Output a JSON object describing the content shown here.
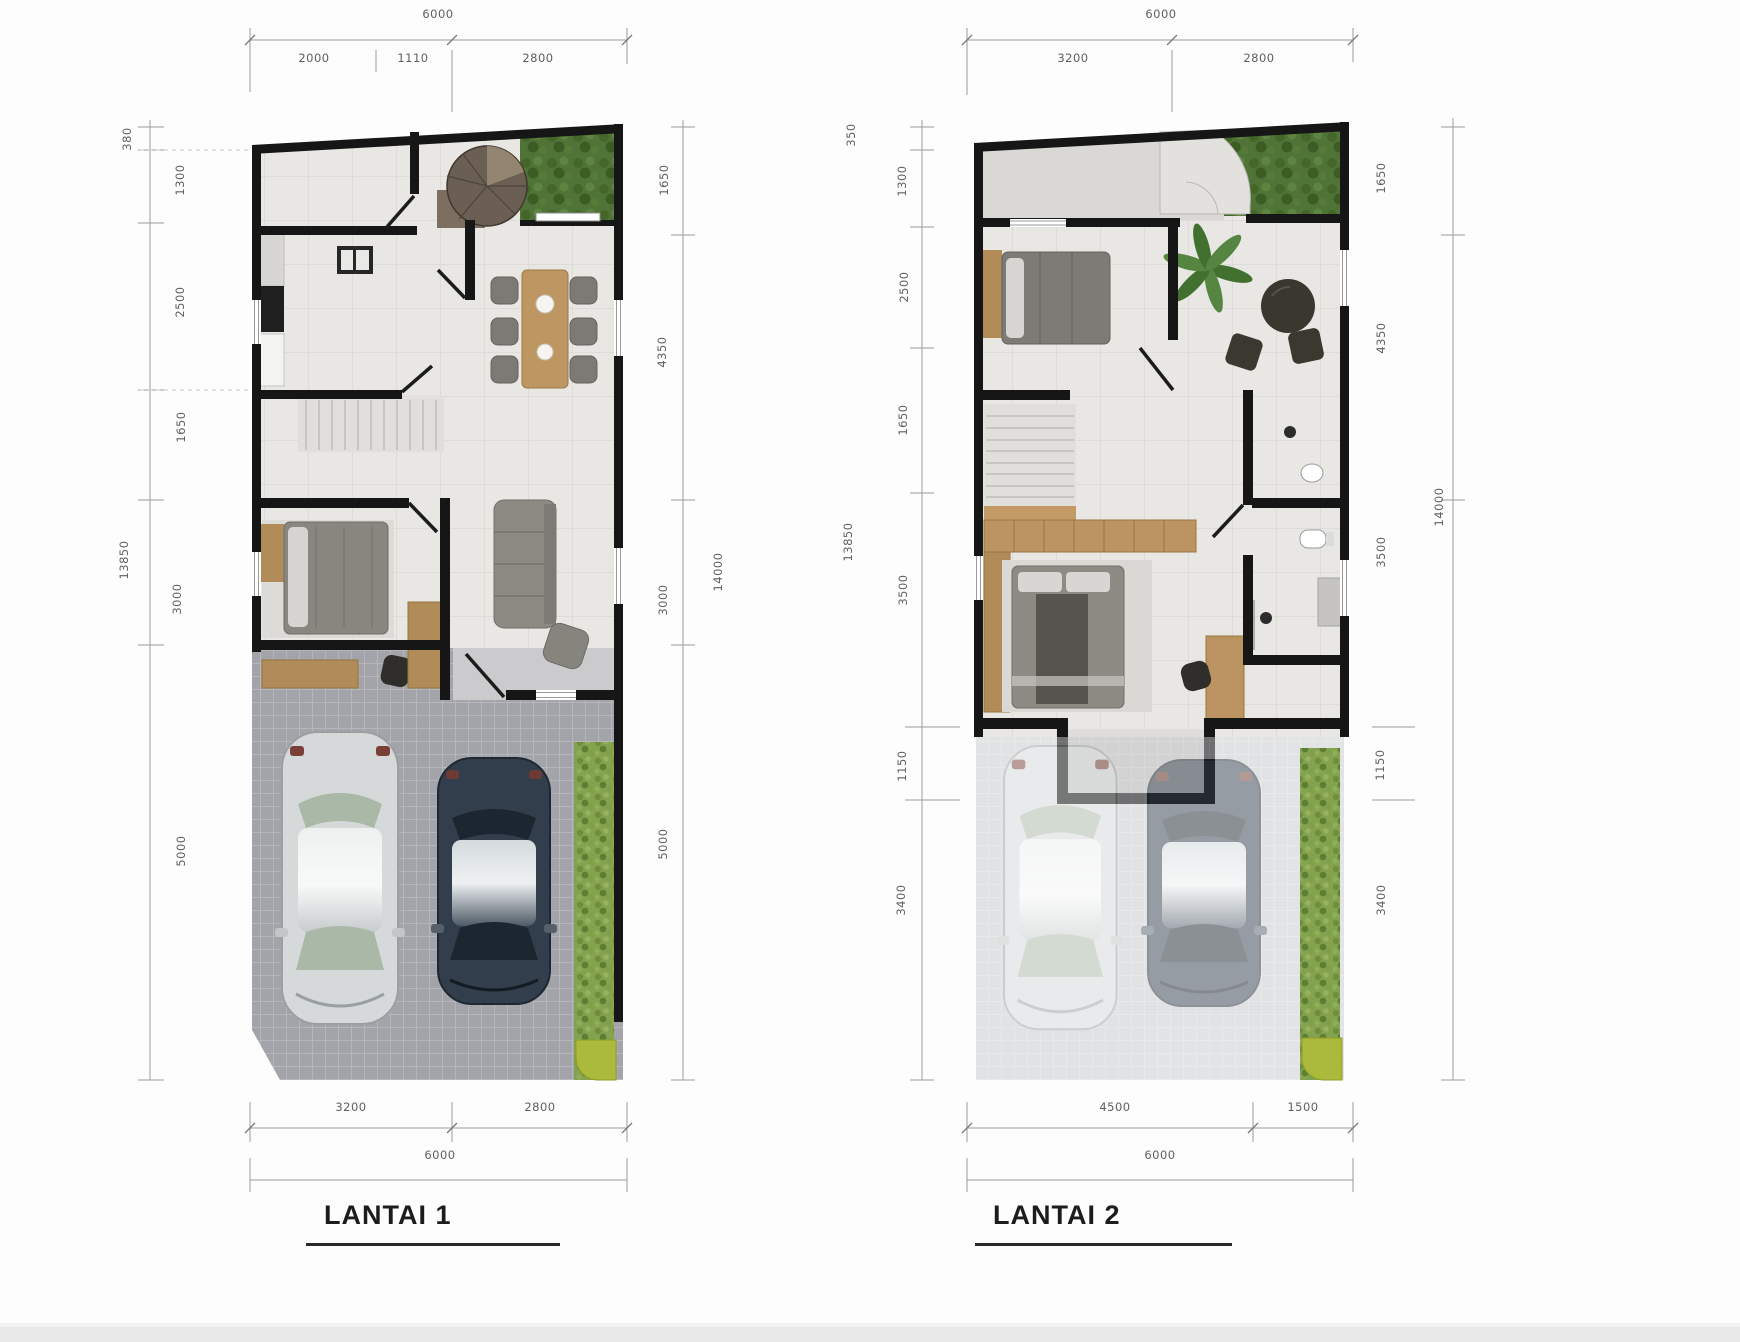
{
  "document": {
    "type": "architectural floor plan, two storeys, scanned drawing"
  },
  "plans": [
    {
      "title": "LANTAI 1",
      "dims": {
        "top_total": "6000",
        "top_segments": [
          "2000",
          "1110",
          "2800"
        ],
        "left_outer": "13850",
        "left_segments": [
          "380",
          "1300",
          "2500",
          "1650",
          "3000",
          "5000"
        ],
        "right_outer": "14000",
        "right_segments": [
          "1650",
          "4350",
          "3000",
          "5000"
        ],
        "bottom_segments": [
          "3200",
          "2800"
        ],
        "bottom_total": "6000"
      }
    },
    {
      "title": "LANTAI 2",
      "dims": {
        "top_total": "6000",
        "top_segments": [
          "3200",
          "2800"
        ],
        "left_outer": "13850",
        "left_segments": [
          "350",
          "1300",
          "2500",
          "1650",
          "3500",
          "1150",
          "3400"
        ],
        "right_outer": "14000",
        "right_segments": [
          "1650",
          "4350",
          "3500",
          "1150",
          "3400"
        ],
        "bottom_segments": [
          "4500",
          "1500"
        ],
        "bottom_total": "6000"
      }
    }
  ],
  "colors": {
    "wall": "#161616",
    "floor": "#e8e7e4",
    "carport_paving": "#a3a4a9",
    "wood": "#bb9461",
    "furniture_grey": "#8b8a83",
    "garden_green": "#507437",
    "hedge_green": "#85a24f",
    "planter_olive": "#abb93c",
    "car_silver": "#d6d9da",
    "car_dark": "#323e4b",
    "dimension_text": "#5f5f5f"
  }
}
